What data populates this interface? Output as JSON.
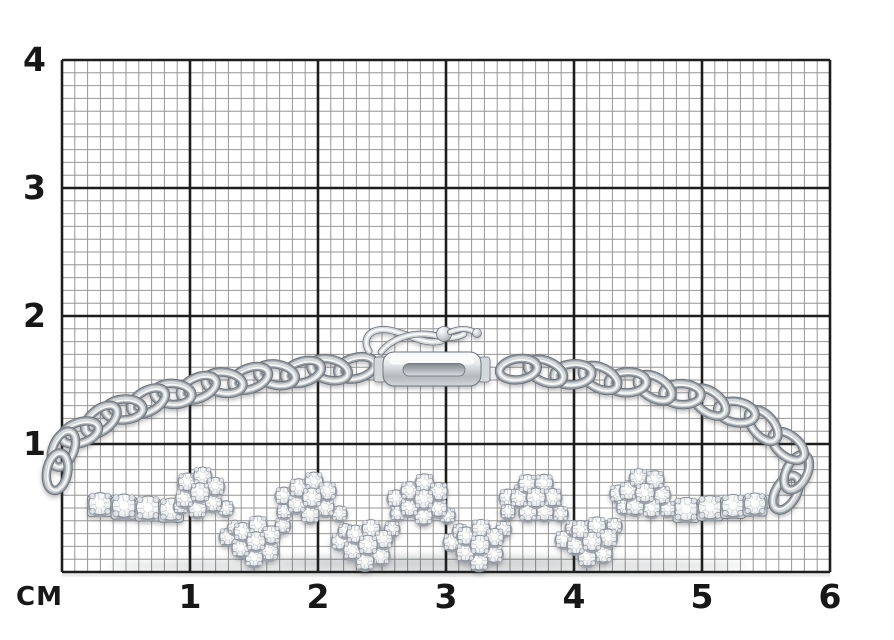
{
  "figure": {
    "type": "product-photo-on-measuring-grid",
    "unit_label": "CM",
    "x_tick_labels": [
      "1",
      "2",
      "3",
      "4",
      "5",
      "6"
    ],
    "y_tick_labels": [
      "4",
      "3",
      "2",
      "1"
    ],
    "grid": {
      "px_per_cm": 128,
      "minor_per_cm": 10,
      "left": 62,
      "top": 60,
      "right": 830,
      "bottom": 572,
      "minor_color": "#848484",
      "major_color": "#1d1d1d",
      "label_color": "#171717",
      "background": "#ffffff"
    },
    "subject": {
      "name": "diamond-cluster-bracelet",
      "approx_width_cm": 5.7,
      "approx_height_cm": 2.0,
      "metal": {
        "light": "#f6f7f8",
        "mid": "#d5d8db",
        "dark": "#9aa0a6",
        "edge": "#6e747b"
      },
      "stone": {
        "light": "#ffffff",
        "mid": "#eef0f2",
        "dark": "#ced2d7",
        "stroke": "#878d94"
      }
    }
  }
}
